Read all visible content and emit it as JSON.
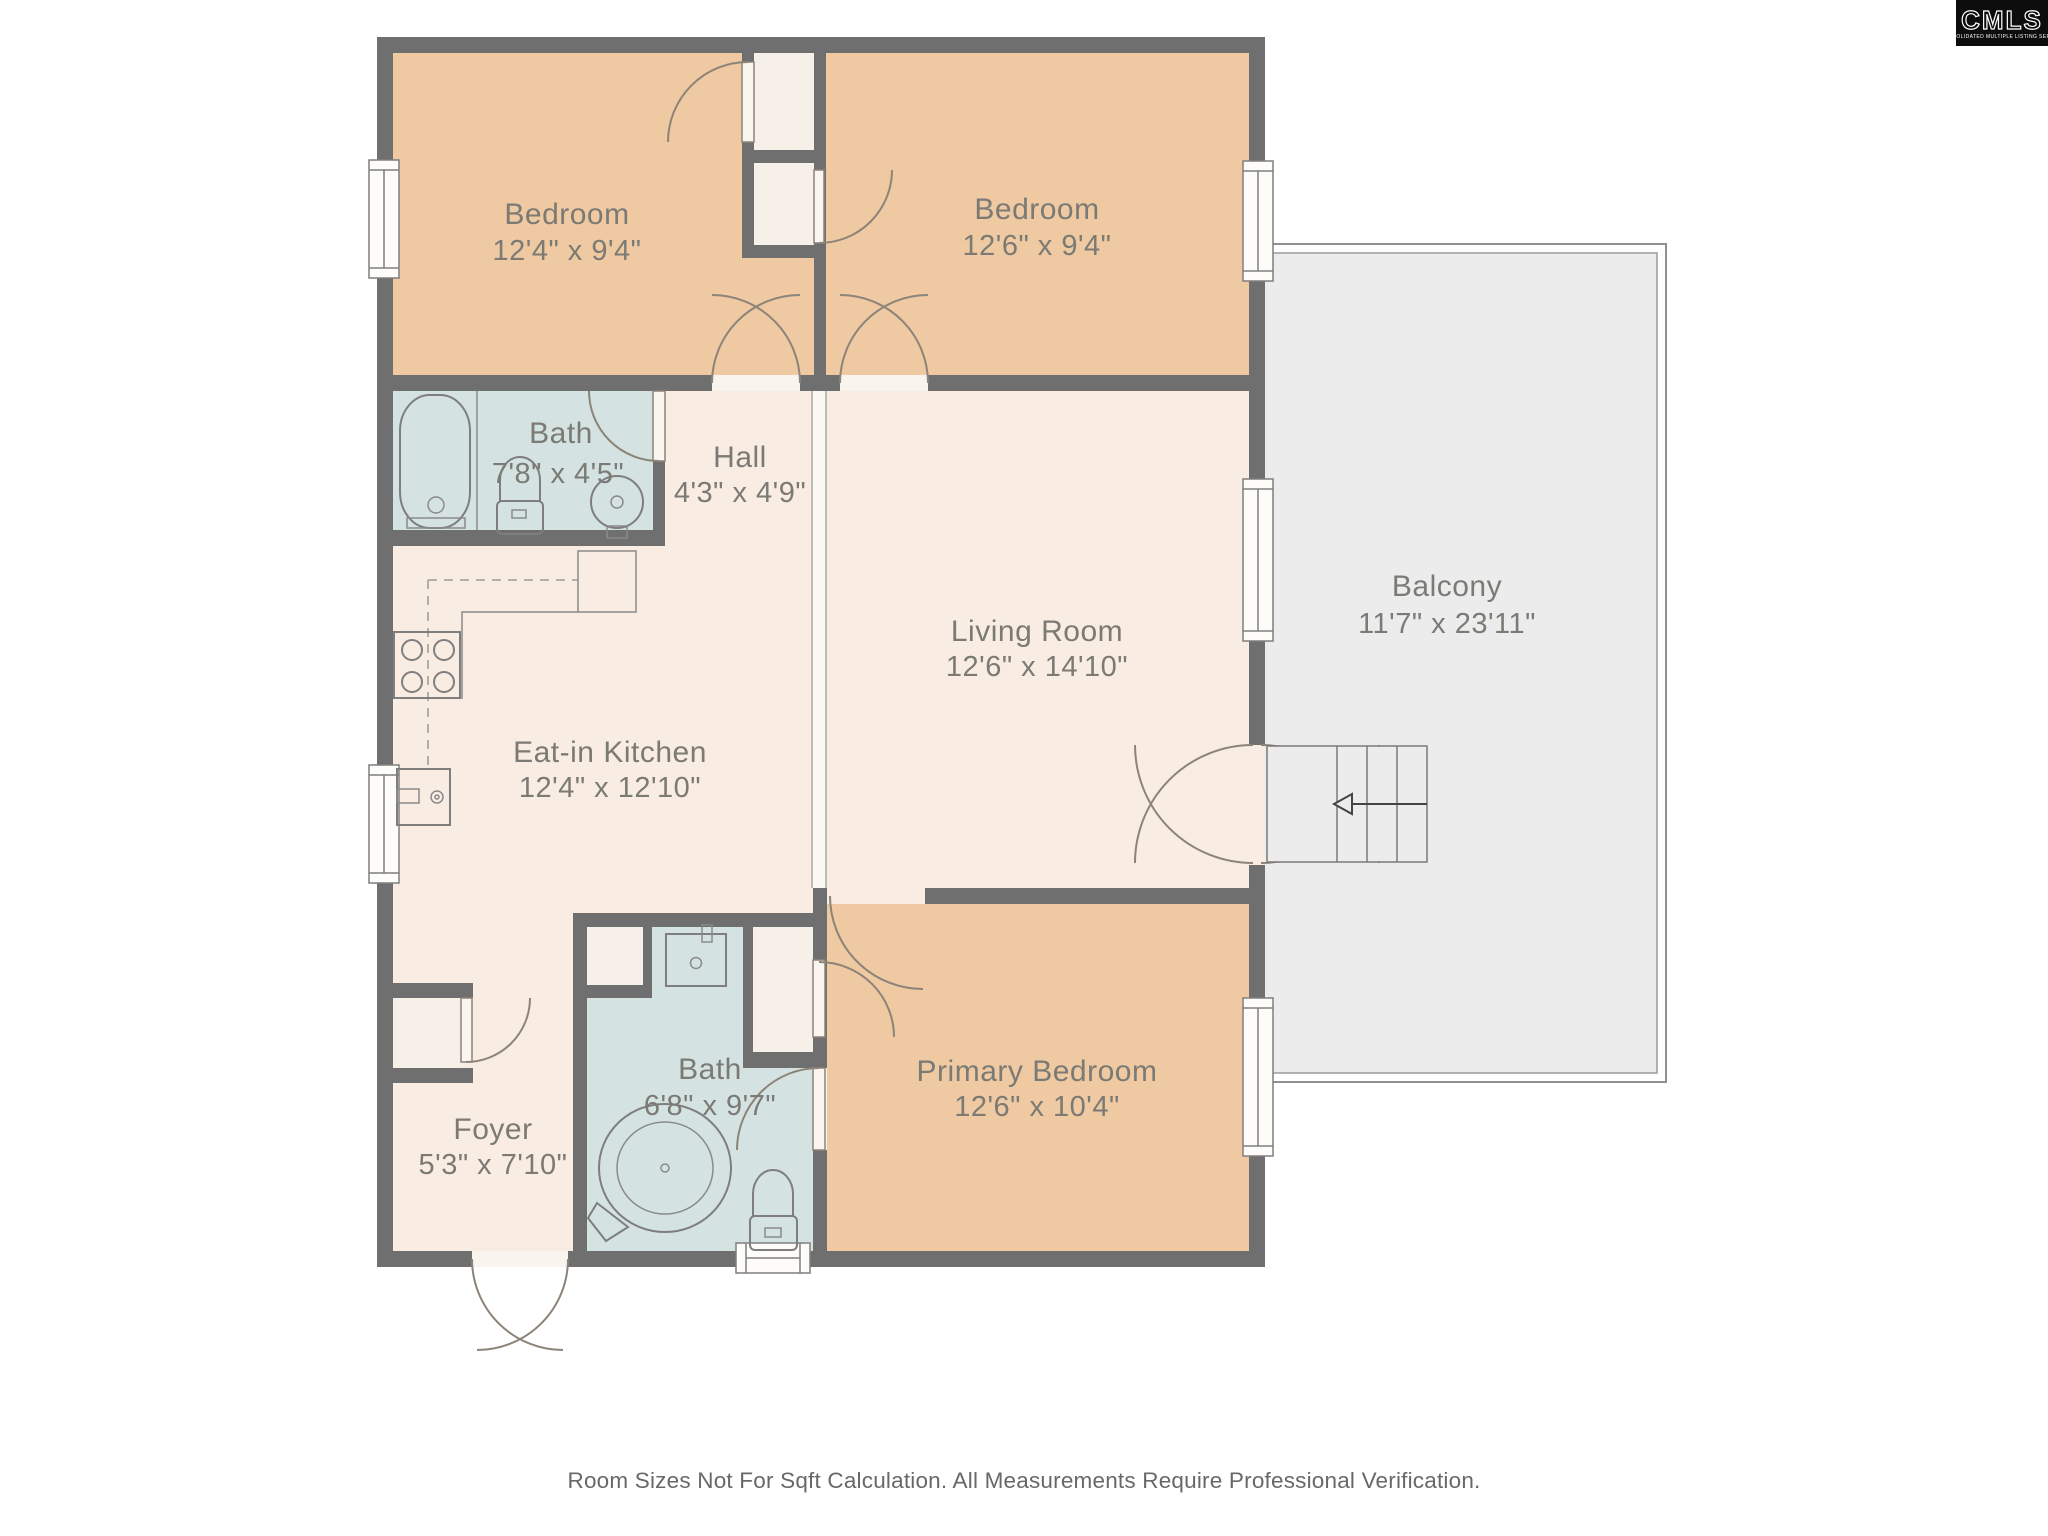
{
  "logo": {
    "title": "CMLS",
    "subtitle": "CONSOLIDATED MULTIPLE LISTING SERVICE"
  },
  "rooms": {
    "bedroom1": {
      "name": "Bedroom",
      "size": "12'4\" x 9'4\""
    },
    "bedroom2": {
      "name": "Bedroom",
      "size": "12'6\" x 9'4\""
    },
    "bath_upper": {
      "name": "Bath",
      "size": "7'8\" x 4'5\""
    },
    "hall": {
      "name": "Hall",
      "size": "4'3\" x 4'9\""
    },
    "living_room": {
      "name": "Living Room",
      "size": "12'6\" x 14'10\""
    },
    "kitchen": {
      "name": "Eat-in Kitchen",
      "size": "12'4\" x 12'10\""
    },
    "balcony": {
      "name": "Balcony",
      "size": "11'7\" x 23'11\""
    },
    "bath_primary": {
      "name": "Bath",
      "size": "6'8\" x 9'7\""
    },
    "primary_bedroom": {
      "name": "Primary Bedroom",
      "size": "12'6\" x 10'4\""
    },
    "foyer": {
      "name": "Foyer",
      "size": "5'3\" x 7'10\""
    }
  },
  "footer": {
    "disclaimer": "Room Sizes Not For Sqft Calculation. All Measurements Require Professional Verification."
  },
  "colors": {
    "wall": "#6f6f6f",
    "cream": "#f8ece3",
    "tan": "#eec9a2",
    "teal": "#d4e3e1",
    "closet": "#f6f0e9",
    "balcony": "#ececec",
    "text": "#7b7a74"
  }
}
